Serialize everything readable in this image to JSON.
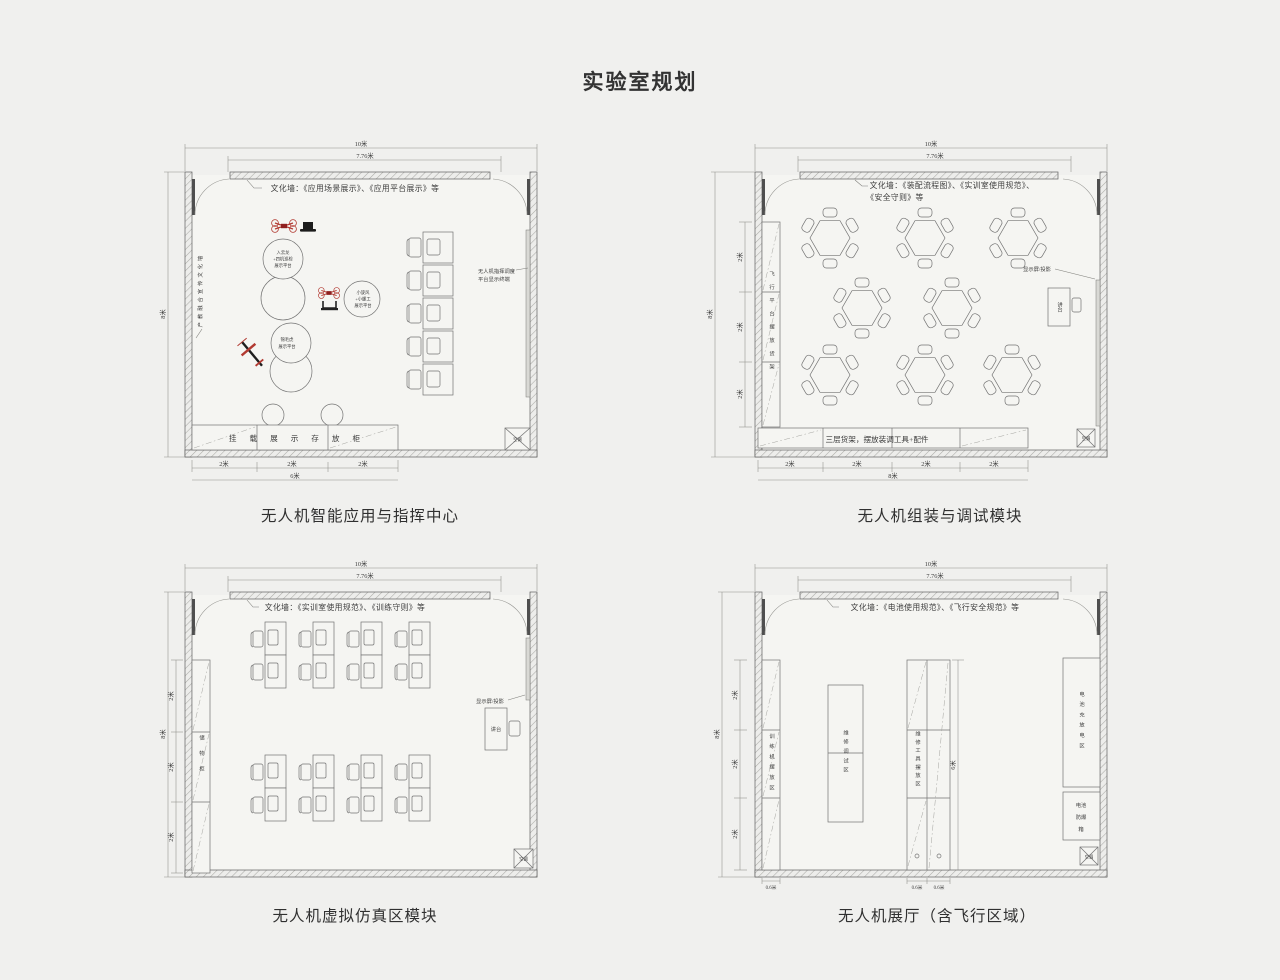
{
  "title": "实验室规划",
  "shared": {
    "dim_10m": "10米",
    "dim_776m": "7.76米",
    "dim_8m": "8米",
    "dim_6m": "6米",
    "dim_2m": "2米",
    "dim_06m": "0.6米",
    "ac_label": "空调",
    "screen_label": "显示屏/投影",
    "podium_label": "讲台"
  },
  "plan1": {
    "caption": "无人机智能应用与指挥中心",
    "wall_text": "文化墙：《应用场景展示》、《应用平台展示》等",
    "left_wall_label": "产教融合宣传文化墙",
    "terminal_line1": "无人机指挥调度",
    "terminal_line2": "平台显示终端",
    "exhibit1_line1": "入云龙",
    "exhibit1_line2": "+四机巡检",
    "exhibit1_line3": "展示平台",
    "exhibit2_line1": "小旋风",
    "exhibit2_line2": "+小螺工",
    "exhibit2_line3": "展示平台",
    "exhibit3_line1": "锦毛虎",
    "exhibit3_line2": "展示平台",
    "cabinet_label": "挂载展示存放柜"
  },
  "plan2": {
    "caption": "无人机组装与调试模块",
    "wall_text_line1": "文化墙：《装配流程图》、《实训室使用规范》、",
    "wall_text_line2": "《安全守则》等",
    "rack_label": "飞行平台摆放货架",
    "shelf_label": "三层货架，摆放装调工具+配件"
  },
  "plan3": {
    "caption": "无人机虚拟仿真区模块",
    "wall_text": "文化墙：《实训室使用规范》、《训练守则》等",
    "cabinet_label": "储物柜"
  },
  "plan4": {
    "caption": "无人机展厅（含飞行区域）",
    "wall_text": "文化墙：《电池使用规范》、《飞行安全规范》等",
    "left_rack_label": "训练机摆放区",
    "repair_label": "维修调试区",
    "tool_rack_label": "维修工具摆放区",
    "battery_charge_label": "电池充放电区",
    "battery_box_line1": "电池",
    "battery_box_line2": "防爆",
    "battery_box_line3": "箱"
  }
}
